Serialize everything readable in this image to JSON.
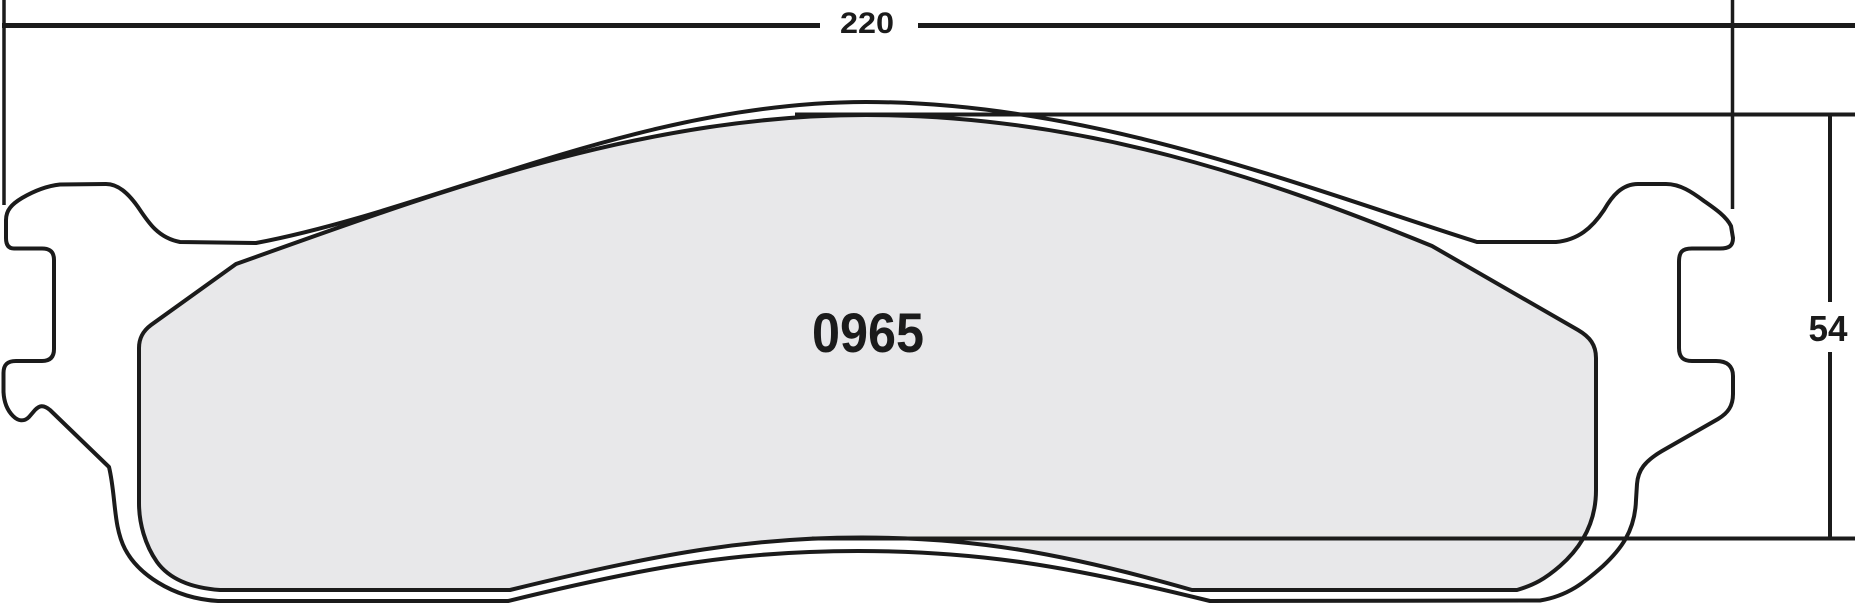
{
  "drawing": {
    "part_number": "0965",
    "width_dimension": "220",
    "height_dimension": "54",
    "colors": {
      "line": "#1b1b1b",
      "plate_fill": "#ffffff",
      "friction_fill": "#e8e8ea"
    }
  }
}
